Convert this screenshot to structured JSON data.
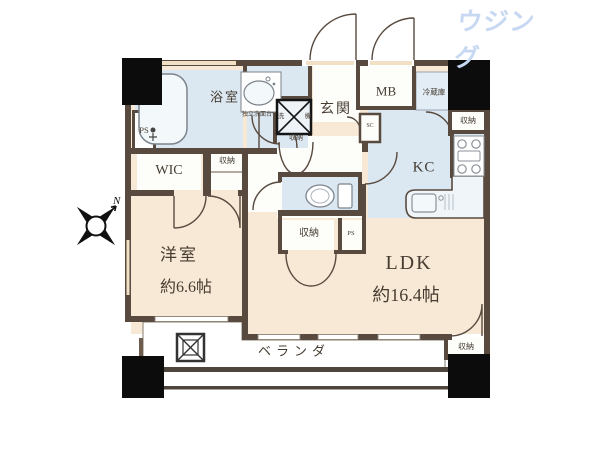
{
  "logo": {
    "text": "住建ハウジング"
  },
  "compass": {
    "north": "N"
  },
  "labels": {
    "bathroom": "浴室",
    "vanity": "独立洗面台",
    "washer_kanji_left": "洗",
    "washer_kanji_right": "機",
    "washer_storage": "収納",
    "entrance": "玄関",
    "meter_box": "MB",
    "refrigerator": "冷蔵庫",
    "shoe_closet": "SC",
    "kitchen": "KC",
    "kitchen_storage": "収納",
    "pipe_space_left": "PS",
    "walk_in_closet": "WIC",
    "wic_side_storage": "収納",
    "toilet_storage": "収納",
    "toilet_pipe_space": "PS",
    "bedroom_name": "洋室",
    "bedroom_size": "約6.6帖",
    "ldk_name": "LDK",
    "ldk_size": "約16.4帖",
    "ldk_storage": "収納",
    "veranda": "ベランダ"
  },
  "colors": {
    "logo_blue": "#c7d8f2",
    "wall": "#584a3f",
    "room_cream": "#f7e9d5",
    "wet_blue": "#dbe7f1",
    "hall_white": "#fdfdfa",
    "window_sill": "#f2e0c4",
    "label_text": "#463c31",
    "block_black": "#0c0c0c"
  }
}
